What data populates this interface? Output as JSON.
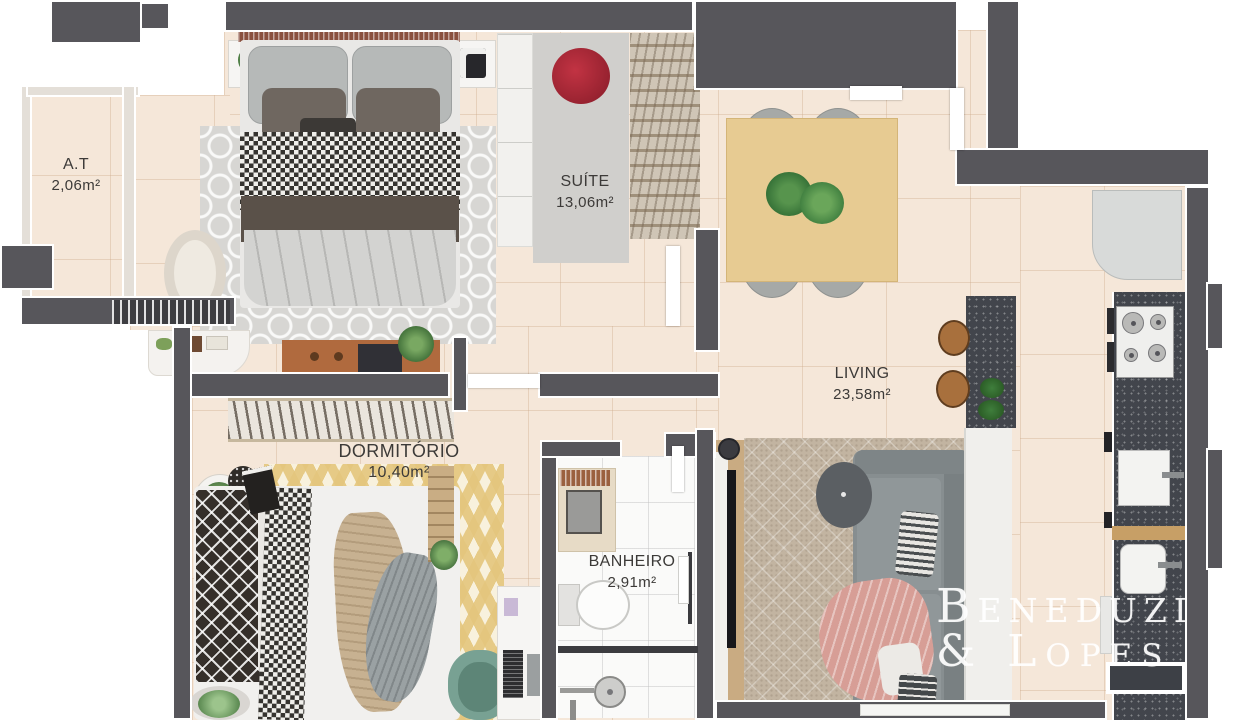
{
  "brand_watermark": {
    "line1": "Beneduzi",
    "line2": "& Lopes"
  },
  "rooms": [
    {
      "name": "A.T",
      "area": "2,06m²"
    },
    {
      "name": "SUÍTE",
      "area": "13,06m²"
    },
    {
      "name": "DORMITÓRIO",
      "area": "10,40m²"
    },
    {
      "name": "BANHEIRO",
      "area": "2,91m²"
    },
    {
      "name": "LIVING",
      "area": "23,58m²"
    }
  ],
  "palette": {
    "wall": "#57565b",
    "floor": "#f5e7d9",
    "bathroom_floor": "#fafaf9",
    "accent_red_pouf": "#ad2634",
    "wood_table": "#e7cb92",
    "counter_dark": "#42454c",
    "sofa_gray": "#878e90",
    "living_rug": "#c2b4a1",
    "chevron_rug": "#e4c67d",
    "teal_chair": "#78a193",
    "watermark_text": "#ffffff"
  },
  "furniture_legend": [
    "double-bed",
    "nightstands",
    "wardrobe",
    "closet-shelves",
    "dresser",
    "vanity",
    "stool",
    "red-pouf",
    "single-bed",
    "side-table",
    "desk",
    "lounge-chair",
    "toilet",
    "bathroom-vanity",
    "shower",
    "tv-panel",
    "sofa",
    "coffee-table",
    "island-counter",
    "bar-stools",
    "dining-table",
    "dining-chairs",
    "fridge",
    "gas-stove",
    "kitchen-sink"
  ]
}
